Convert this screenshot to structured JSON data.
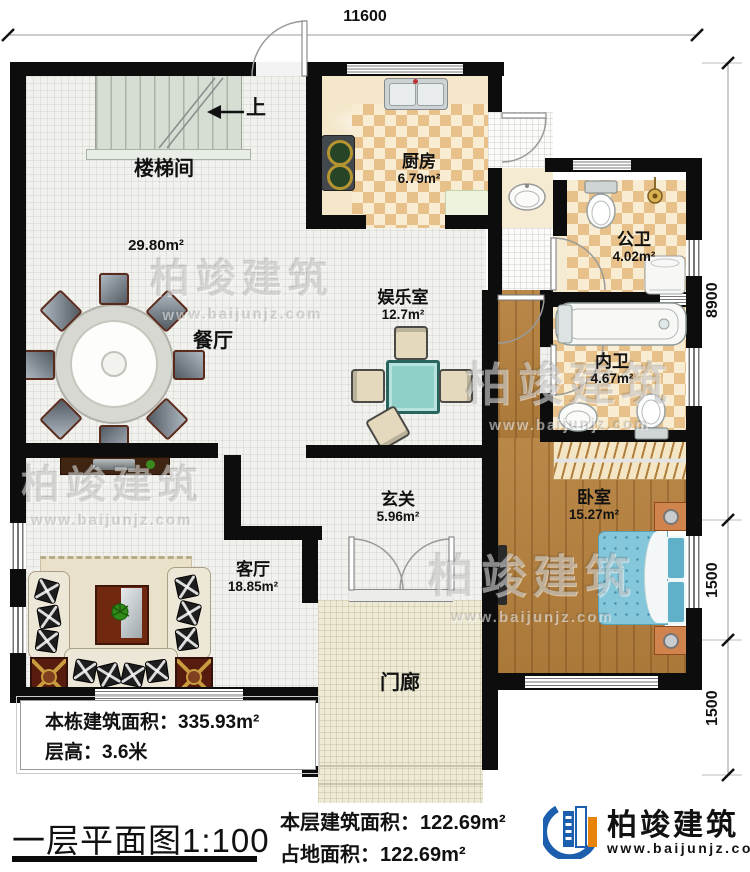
{
  "plan": {
    "dims": {
      "top": "11600",
      "right_main": "8900",
      "right_mid": "1500",
      "right_bottom": "1500"
    },
    "stairs": {
      "up_label": "上"
    },
    "rooms": {
      "stairwell": {
        "name": "楼梯间"
      },
      "open_area": {
        "area": "29.80m²"
      },
      "dining": {
        "name": "餐厅"
      },
      "kitchen": {
        "name": "厨房",
        "area": "6.79m²"
      },
      "entertainment": {
        "name": "娱乐室",
        "area": "12.7m²"
      },
      "public_bath": {
        "name": "公卫",
        "area": "4.02m²"
      },
      "private_bath": {
        "name": "内卫",
        "area": "4.67m²"
      },
      "bedroom": {
        "name": "卧室",
        "area": "15.27m²"
      },
      "foyer": {
        "name": "玄关",
        "area": "5.96m²"
      },
      "living": {
        "name": "客厅",
        "area": "18.85m²"
      },
      "porch": {
        "name": "门廊"
      }
    }
  },
  "info_box": {
    "line1": "本栋建筑面积：335.93m²",
    "line2": "层高：3.6米"
  },
  "footer": {
    "title": "一层平面图1:100",
    "floor_area": "本层建筑面积：122.69m²",
    "ground_area": "占地面积：122.69m²"
  },
  "brand": {
    "name": "柏竣建筑",
    "url": "www.baijunjz.com"
  },
  "watermark": {
    "text": "柏竣建筑",
    "url": "www.baijunjz.com"
  },
  "colors": {
    "wall": "#0d0d0d",
    "wood": "#b5803c",
    "checker_dark": "#e7c189",
    "bed": "#84c6da",
    "brand_blue": "#1b5fae",
    "brand_orange": "#e8830a"
  }
}
